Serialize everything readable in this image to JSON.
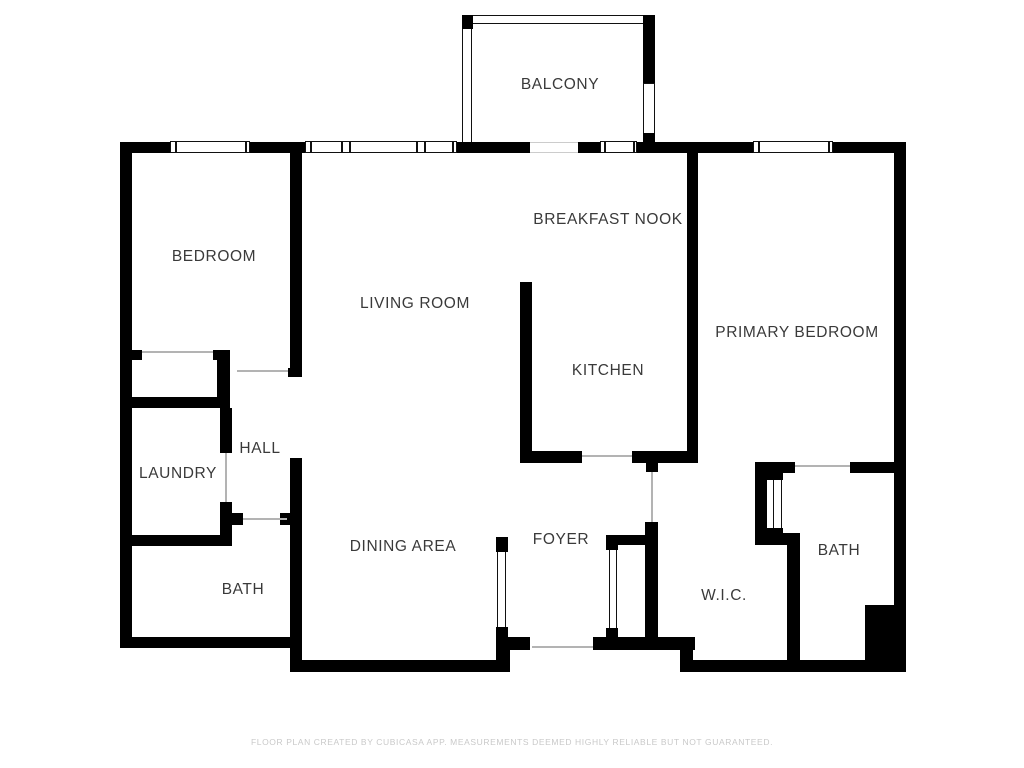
{
  "page": {
    "width": 1024,
    "height": 768,
    "background": "#ffffff"
  },
  "colors": {
    "wall": "#000000",
    "window_frame": "#111111",
    "door_line": "#b3b3b3",
    "label_text": "#3a3a3a",
    "footer_text": "#c9c9c9"
  },
  "rooms": [
    {
      "label": "BALCONY",
      "x": 560,
      "y": 85
    },
    {
      "label": "BEDROOM",
      "x": 214,
      "y": 257
    },
    {
      "label": "BREAKFAST NOOK",
      "x": 608,
      "y": 220
    },
    {
      "label": "LIVING ROOM",
      "x": 415,
      "y": 304
    },
    {
      "label": "PRIMARY BEDROOM",
      "x": 797,
      "y": 333
    },
    {
      "label": "KITCHEN",
      "x": 608,
      "y": 371
    },
    {
      "label": "HALL",
      "x": 260,
      "y": 449
    },
    {
      "label": "LAUNDRY",
      "x": 178,
      "y": 474
    },
    {
      "label": "DINING AREA",
      "x": 403,
      "y": 547
    },
    {
      "label": "FOYER",
      "x": 561,
      "y": 540
    },
    {
      "label": "BATH",
      "x": 243,
      "y": 590
    },
    {
      "label": "W.I.C.",
      "x": 724,
      "y": 596
    },
    {
      "label": "BATH",
      "x": 839,
      "y": 551
    }
  ],
  "walls": [
    {
      "name": "exterior-top",
      "x": 120,
      "y": 142,
      "w": 786,
      "h": 11
    },
    {
      "name": "exterior-left",
      "x": 120,
      "y": 142,
      "w": 12,
      "h": 506
    },
    {
      "name": "bath-left-bottom",
      "x": 120,
      "y": 637,
      "w": 182,
      "h": 11
    },
    {
      "name": "bedroom-east",
      "x": 290,
      "y": 142,
      "w": 12,
      "h": 235
    },
    {
      "name": "dining-west",
      "x": 290,
      "y": 458,
      "w": 12,
      "h": 214
    },
    {
      "name": "exterior-bottom-center",
      "x": 290,
      "y": 660,
      "w": 220,
      "h": 12
    },
    {
      "name": "foyer-bottom",
      "x": 498,
      "y": 637,
      "w": 197,
      "h": 13
    },
    {
      "name": "foyer-bottom-post",
      "x": 498,
      "y": 637,
      "w": 12,
      "h": 35
    },
    {
      "name": "bottom-step",
      "x": 680,
      "y": 650,
      "w": 13,
      "h": 12
    },
    {
      "name": "exterior-bottom-right",
      "x": 680,
      "y": 660,
      "w": 226,
      "h": 12
    },
    {
      "name": "exterior-right",
      "x": 894,
      "y": 142,
      "w": 12,
      "h": 530
    },
    {
      "name": "pipe-chase",
      "x": 865,
      "y": 605,
      "w": 41,
      "h": 65
    },
    {
      "name": "bedroom-south-stub",
      "x": 120,
      "y": 350,
      "w": 22,
      "h": 10
    },
    {
      "name": "closet-corner-h",
      "x": 213,
      "y": 350,
      "w": 17,
      "h": 10
    },
    {
      "name": "closet-corner-v",
      "x": 217,
      "y": 352,
      "w": 13,
      "h": 56
    },
    {
      "name": "bedroom-door-jamb",
      "x": 288,
      "y": 368,
      "w": 14,
      "h": 9
    },
    {
      "name": "laundry-north",
      "x": 120,
      "y": 397,
      "w": 108,
      "h": 11
    },
    {
      "name": "laundry-east-upper",
      "x": 220,
      "y": 408,
      "w": 12,
      "h": 45
    },
    {
      "name": "laundry-east-lower",
      "x": 220,
      "y": 502,
      "w": 12,
      "h": 44
    },
    {
      "name": "laundry-south",
      "x": 120,
      "y": 535,
      "w": 112,
      "h": 11
    },
    {
      "name": "hall-south-stub-left",
      "x": 230,
      "y": 513,
      "w": 13,
      "h": 12
    },
    {
      "name": "hall-south-stub-right",
      "x": 280,
      "y": 513,
      "w": 12,
      "h": 12
    },
    {
      "name": "kitchen-peninsula",
      "x": 520,
      "y": 282,
      "w": 12,
      "h": 181
    },
    {
      "name": "kitchen-south-west",
      "x": 520,
      "y": 451,
      "w": 62,
      "h": 12
    },
    {
      "name": "kitchen-south-east",
      "x": 632,
      "y": 451,
      "w": 63,
      "h": 12
    },
    {
      "name": "wic-west-stub",
      "x": 646,
      "y": 462,
      "w": 12,
      "h": 10
    },
    {
      "name": "wic-west",
      "x": 645,
      "y": 522,
      "w": 13,
      "h": 118
    },
    {
      "name": "foyer-closet-top",
      "x": 608,
      "y": 535,
      "w": 40,
      "h": 10
    },
    {
      "name": "foyer-closet-stub-top",
      "x": 606,
      "y": 535,
      "w": 12,
      "h": 15
    },
    {
      "name": "foyer-closet-stub-bottom",
      "x": 606,
      "y": 628,
      "w": 12,
      "h": 12
    },
    {
      "name": "dining-slider-cap-top",
      "x": 496,
      "y": 537,
      "w": 12,
      "h": 15
    },
    {
      "name": "dining-slider-cap-bottom",
      "x": 496,
      "y": 627,
      "w": 12,
      "h": 45
    },
    {
      "name": "primary-west",
      "x": 687,
      "y": 153,
      "w": 11,
      "h": 310
    },
    {
      "name": "bath2-north-west",
      "x": 755,
      "y": 462,
      "w": 40,
      "h": 11
    },
    {
      "name": "bath2-north-east",
      "x": 850,
      "y": 462,
      "w": 56,
      "h": 11
    },
    {
      "name": "bath2-closet-west",
      "x": 755,
      "y": 462,
      "w": 12,
      "h": 81
    },
    {
      "name": "bath2-closet-stub-top",
      "x": 765,
      "y": 468,
      "w": 18,
      "h": 12
    },
    {
      "name": "bath2-closet-stub-bottom",
      "x": 765,
      "y": 528,
      "w": 18,
      "h": 12
    },
    {
      "name": "wic-bath-divider-h",
      "x": 755,
      "y": 533,
      "w": 45,
      "h": 12
    },
    {
      "name": "wic-bath-divider-v",
      "x": 787,
      "y": 533,
      "w": 13,
      "h": 130
    },
    {
      "name": "balcony-corner-cap",
      "x": 462,
      "y": 15,
      "w": 11,
      "h": 14
    },
    {
      "name": "balcony-right-wall",
      "x": 643,
      "y": 15,
      "w": 12,
      "h": 68
    },
    {
      "name": "balcony-right-tab",
      "x": 643,
      "y": 133,
      "w": 12,
      "h": 20
    }
  ],
  "railings": [
    {
      "name": "balcony-top-rail",
      "x": 462,
      "y": 15,
      "w": 193,
      "h": 9
    },
    {
      "name": "balcony-left-rail",
      "x": 462,
      "y": 15,
      "w": 10,
      "h": 137
    },
    {
      "name": "balcony-right-rail",
      "x": 643,
      "y": 83,
      "w": 12,
      "h": 52
    },
    {
      "name": "foyer-closet-door",
      "x": 609,
      "y": 548,
      "w": 8,
      "h": 82
    },
    {
      "name": "dining-slider-door",
      "x": 497,
      "y": 551,
      "w": 9,
      "h": 78
    },
    {
      "name": "bath2-closet-door",
      "x": 773,
      "y": 478,
      "w": 9,
      "h": 52
    }
  ],
  "windows": [
    {
      "name": "bedroom-window",
      "x": 170,
      "y": 141,
      "w": 80,
      "h": 12,
      "mullions": [
        4,
        74
      ]
    },
    {
      "name": "living-window",
      "x": 305,
      "y": 141,
      "w": 152,
      "h": 12,
      "mullions": [
        4,
        35,
        43,
        110,
        118,
        146
      ]
    },
    {
      "name": "kitchen-window",
      "x": 600,
      "y": 141,
      "w": 37,
      "h": 12,
      "mullions": [
        3,
        32
      ]
    },
    {
      "name": "primary-window",
      "x": 753,
      "y": 141,
      "w": 80,
      "h": 12,
      "mullions": [
        4,
        74
      ]
    }
  ],
  "openings": [
    {
      "name": "balcony-door-opening",
      "x": 530,
      "y": 142,
      "w": 48,
      "h": 11,
      "framed": true
    },
    {
      "name": "entry-door-opening",
      "x": 530,
      "y": 637,
      "w": 63,
      "h": 13,
      "framed": false
    }
  ],
  "door_lines": [
    {
      "name": "bedroom-closet-door",
      "x": 142,
      "y": 351,
      "len": 71,
      "dir": "h"
    },
    {
      "name": "bedroom-entry-door",
      "x": 237,
      "y": 370,
      "len": 51,
      "dir": "h"
    },
    {
      "name": "laundry-door",
      "x": 225,
      "y": 453,
      "len": 49,
      "dir": "v"
    },
    {
      "name": "hall-bath-door",
      "x": 243,
      "y": 518,
      "len": 44,
      "dir": "h"
    },
    {
      "name": "kitchen-foyer-door",
      "x": 582,
      "y": 455,
      "len": 50,
      "dir": "h"
    },
    {
      "name": "wic-door",
      "x": 651,
      "y": 472,
      "len": 50,
      "dir": "v"
    },
    {
      "name": "bath2-door",
      "x": 795,
      "y": 465,
      "len": 55,
      "dir": "h"
    },
    {
      "name": "entry-door",
      "x": 532,
      "y": 646,
      "len": 61,
      "dir": "h"
    }
  ],
  "footer": {
    "text": "FLOOR PLAN CREATED BY CUBICASA APP. MEASUREMENTS DEEMED HIGHLY RELIABLE BUT NOT GUARANTEED.",
    "y": 737
  }
}
